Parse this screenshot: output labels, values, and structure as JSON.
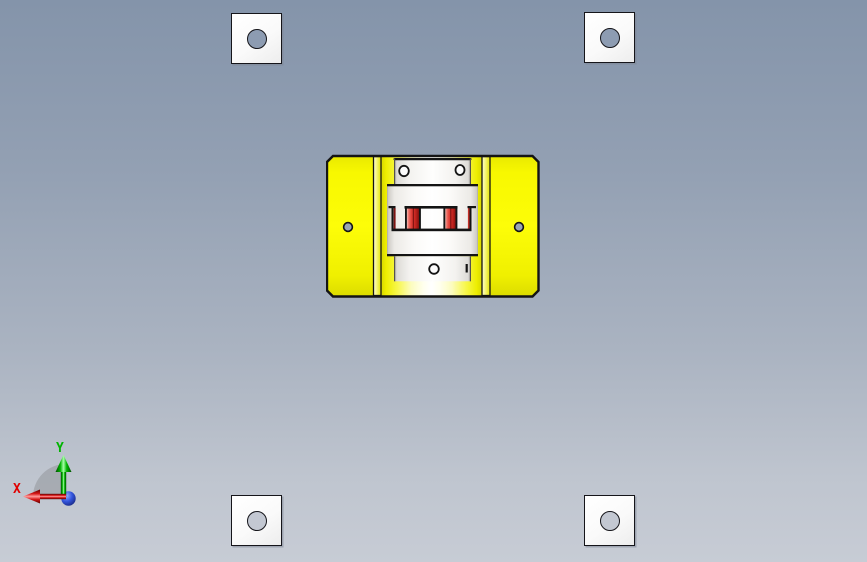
{
  "viewport": {
    "background_top": "#8494aa",
    "background_bottom": "#c7ccd5"
  },
  "origin_triad": {
    "x_label": "X",
    "y_label": "Y",
    "x_axis_color": "#e00000",
    "y_axis_color": "#00b400",
    "z_ball_color": "#2a4bd7",
    "sector_color": "#a0a4aa"
  },
  "corner_plates": {
    "face_color": "#fafafa",
    "outline_color": "#15151a",
    "top_hole_color": "#8d9cb2",
    "bottom_hole_color": "#c3c8d2"
  },
  "center_assembly": {
    "base_plate_color": "#fafa00",
    "rail_color": "#f6f670",
    "hub_color": "#f6f5f2",
    "spider_color": "#d9352c",
    "outline_color": "#141414",
    "wing_hole_color": "#9aa5b4"
  }
}
